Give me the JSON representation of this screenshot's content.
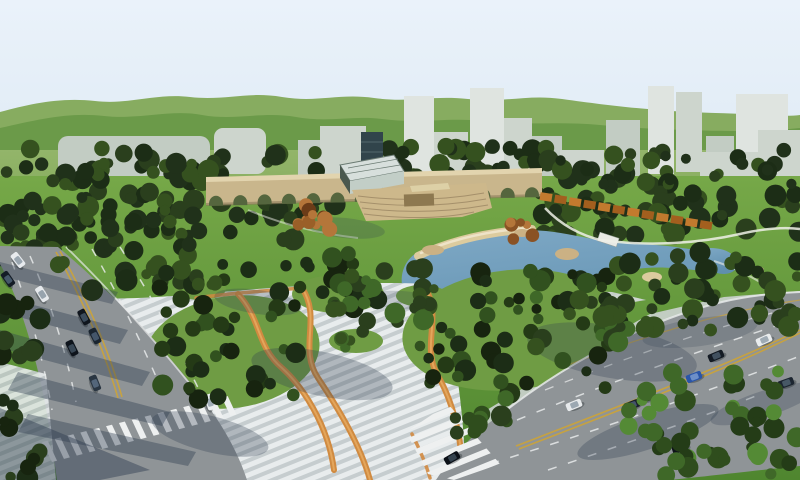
{
  "meta": {
    "description": "Aerial 3D architectural rendering of an urban park master plan: central lawn with arched bridge structure, glass pavilion and amphitheater, blue lake with sand beach and rocks, striped pedestrian plaza with winding orange paths, dense tree masses, two multi-lane boulevards with traffic and zebra crosswalks, pale city towers and green hills on the horizon",
    "render_width": 800,
    "render_height": 480
  },
  "palette": {
    "sky": "#eaf2fa",
    "sky_low": "#dde9f4",
    "hill_back": "#87ac60",
    "hill_front": "#6b9a49",
    "field_hi": "#93b56a",
    "field_lo": "#7ca653",
    "lawn_hi": "#76a848",
    "lawn_lo": "#4f862f",
    "building_light": "#dfe4e0",
    "building_mid": "#cdd5cd",
    "building_shade": "#c2ccc3",
    "tower_dark": "#31444b",
    "tower_stripe": "#54676e",
    "forest_dark": "#1c2d16",
    "forest_mid": "#2a3f1d",
    "autumn": "#8a5224",
    "autumn_light": "#b4763a",
    "structure_tan": "#c9b68c",
    "structure_cornice": "#e2d4ae",
    "structure_base": "#8a7a58",
    "arch_opening": "#55663e",
    "step_tan": "#cdb88b",
    "step_line": "#a5906b",
    "stage_brown": "#8d7850",
    "roof_cream": "#ddd0a6",
    "glass": "#d7dfdc",
    "glass_frame": "#6a7a72",
    "glass_side": "#4a584e",
    "glass_base": "#c2cec7",
    "wall_orange": "#c27a2e",
    "wall_orange_dark": "#a35f1e",
    "pond_hi": "#7fa9c6",
    "pond_lo": "#5f8fae",
    "pond_rim": "#c9d8e2",
    "sand": "#dccb9e",
    "sand_light": "#eee3c8",
    "rock": "#cbb184",
    "island_green": "#5d8f3a",
    "path_white": "#eef0e8",
    "plaza_stripe": "#e8eced",
    "plaza_stripe_dark": "#c6cdcf",
    "ribbon_orange": "#d08a40",
    "ribbon_light": "#e3a65c",
    "road": "#8f9497",
    "lane_white": "#e8eaea",
    "lane_yellow": "#c9a23c",
    "zebra_white": "#eef0f0",
    "curb": "#e4e8e9",
    "pavement_right": "#ccd3d0",
    "mound_green": "#6f9c44",
    "shadow": "#2e3c50",
    "car_shadow": "#10161c",
    "bridge_white": "#e9eae5"
  },
  "skyline": {
    "blocks": [
      {
        "x": 58,
        "y": 136,
        "w": 152,
        "h": 42,
        "rx": 10,
        "c": "building_shade"
      },
      {
        "x": 214,
        "y": 128,
        "w": 52,
        "h": 46,
        "rx": 9,
        "c": "building_mid"
      },
      {
        "x": 298,
        "y": 140,
        "w": 26,
        "h": 44,
        "rx": 0,
        "c": "building_shade"
      },
      {
        "x": 320,
        "y": 126,
        "w": 46,
        "h": 58,
        "rx": 0,
        "c": "building_mid"
      },
      {
        "x": 404,
        "y": 96,
        "w": 30,
        "h": 82,
        "rx": 0,
        "c": "building_light"
      },
      {
        "x": 434,
        "y": 132,
        "w": 34,
        "h": 46,
        "rx": 0,
        "c": "building_mid"
      },
      {
        "x": 470,
        "y": 88,
        "w": 34,
        "h": 90,
        "rx": 0,
        "c": "building_light"
      },
      {
        "x": 504,
        "y": 118,
        "w": 28,
        "h": 58,
        "rx": 0,
        "c": "building_mid"
      },
      {
        "x": 532,
        "y": 136,
        "w": 30,
        "h": 42,
        "rx": 0,
        "c": "building_shade"
      },
      {
        "x": 560,
        "y": 150,
        "w": 44,
        "h": 28,
        "rx": 0,
        "c": "building_mid"
      },
      {
        "x": 606,
        "y": 120,
        "w": 34,
        "h": 56,
        "rx": 0,
        "c": "building_shade"
      },
      {
        "x": 648,
        "y": 86,
        "w": 26,
        "h": 88,
        "rx": 0,
        "c": "building_light"
      },
      {
        "x": 676,
        "y": 92,
        "w": 26,
        "h": 80,
        "rx": 0,
        "c": "building_mid"
      },
      {
        "x": 706,
        "y": 136,
        "w": 28,
        "h": 40,
        "rx": 0,
        "c": "building_shade"
      },
      {
        "x": 736,
        "y": 94,
        "w": 52,
        "h": 78,
        "rx": 0,
        "c": "building_light"
      },
      {
        "x": 758,
        "y": 130,
        "w": 42,
        "h": 46,
        "rx": 0,
        "c": "building_mid"
      },
      {
        "x": 700,
        "y": 152,
        "w": 100,
        "h": 28,
        "rx": 0,
        "c": "building_mid"
      }
    ]
  },
  "forest": {
    "patches": [
      {
        "layer": "upper",
        "name": "forest-band-left",
        "x": 0,
        "y": 148,
        "w": 335,
        "h": 92,
        "n": 115,
        "seed": 7
      },
      {
        "layer": "upper",
        "name": "forest-band-center",
        "x": 375,
        "y": 146,
        "w": 175,
        "h": 44,
        "n": 50,
        "seed": 11
      },
      {
        "layer": "upper",
        "name": "forest-band-right",
        "x": 535,
        "y": 148,
        "w": 265,
        "h": 88,
        "n": 95,
        "seed": 13
      },
      {
        "layer": "upper",
        "name": "trees-topleft-roadside",
        "x": 0,
        "y": 205,
        "w": 70,
        "h": 55,
        "n": 16,
        "seed": 17
      },
      {
        "layer": "lower",
        "name": "trees-roadside-east",
        "x": 58,
        "y": 212,
        "w": 140,
        "h": 80,
        "n": 34,
        "seed": 19
      },
      {
        "layer": "lower",
        "name": "plaza-tree-cluster-west",
        "x": 158,
        "y": 262,
        "w": 150,
        "h": 138,
        "n": 42,
        "seed": 23,
        "colors": [
          "#17240f",
          "forest_dark",
          "#243a16",
          "#31511f"
        ]
      },
      {
        "layer": "lower",
        "name": "plaza-tree-cluster-north",
        "x": 296,
        "y": 252,
        "w": 84,
        "h": 58,
        "n": 18,
        "seed": 29,
        "colors": [
          "#17240f",
          "forest_dark",
          "#243a16",
          "#31511f"
        ]
      },
      {
        "layer": "lower",
        "name": "plaza-tree-cluster-central",
        "x": 418,
        "y": 266,
        "w": 205,
        "h": 128,
        "n": 55,
        "seed": 31,
        "colors": [
          "#17240f",
          "forest_dark",
          "#243a16",
          "#31511f"
        ]
      },
      {
        "layer": "lower",
        "name": "pond-west-trees",
        "x": 366,
        "y": 266,
        "w": 62,
        "h": 58,
        "n": 14,
        "seed": 37,
        "colors": [
          "forest_mid",
          "#35511f",
          "#3f6828"
        ]
      },
      {
        "layer": "lower",
        "name": "pond-east-trees",
        "x": 608,
        "y": 252,
        "w": 192,
        "h": 78,
        "n": 48,
        "seed": 41,
        "colors": [
          "forest_dark",
          "forest_mid",
          "#35511f"
        ]
      },
      {
        "layer": "lower",
        "name": "corner-trees-southeast",
        "x": 618,
        "y": 368,
        "w": 182,
        "h": 112,
        "n": 48,
        "seed": 43,
        "colors": [
          "#2f4d1d",
          "#3f6828",
          "#548a35",
          "#243c17"
        ]
      },
      {
        "layer": "lower",
        "name": "roadside-trees-west",
        "x": 0,
        "y": 298,
        "w": 44,
        "h": 182,
        "n": 24,
        "seed": 47,
        "colors": [
          "#17240f",
          "forest_dark",
          "forest_mid"
        ]
      },
      {
        "layer": "lower",
        "name": "verge-trees-north",
        "x": 532,
        "y": 296,
        "w": 96,
        "h": 52,
        "n": 18,
        "seed": 53,
        "colors": [
          "forest_mid",
          "#35511f",
          "#3f6828"
        ]
      },
      {
        "layer": "lower",
        "name": "autumn-trees-lawn",
        "x": 292,
        "y": 196,
        "w": 38,
        "h": 40,
        "n": 11,
        "seed": 59,
        "rmin": 4,
        "rmax": 9,
        "colors": [
          "autumn",
          "#9a5f28",
          "autumn_light",
          "#6b3c18"
        ]
      },
      {
        "layer": "lower",
        "name": "autumn-shrubs-pond",
        "x": 504,
        "y": 220,
        "w": 34,
        "h": 24,
        "n": 7,
        "seed": 61,
        "rmin": 3,
        "rmax": 7,
        "colors": [
          "autumn",
          "autumn_light",
          "#9a5f28"
        ]
      },
      {
        "layer": "lower",
        "name": "plaza-lone-trees-a",
        "x": 326,
        "y": 276,
        "w": 44,
        "h": 38,
        "n": 9,
        "seed": 67,
        "rmin": 4,
        "rmax": 9,
        "colors": [
          "forest_mid",
          "#35511f",
          "#3f6828"
        ]
      },
      {
        "layer": "lower",
        "name": "plaza-lone-trees-b",
        "x": 338,
        "y": 328,
        "w": 30,
        "h": 24,
        "n": 6,
        "seed": 71,
        "rmin": 4,
        "rmax": 8,
        "colors": [
          "forest_mid",
          "#35511f",
          "#3f6828"
        ]
      },
      {
        "layer": "lower",
        "name": "plaza-lone-trees-c",
        "x": 192,
        "y": 278,
        "w": 26,
        "h": 20,
        "n": 5,
        "seed": 73,
        "rmin": 4,
        "rmax": 8,
        "colors": [
          "forest_mid",
          "#35511f"
        ]
      },
      {
        "layer": "lower",
        "name": "plaza-lone-trees-d",
        "x": 414,
        "y": 286,
        "w": 26,
        "h": 20,
        "n": 5,
        "seed": 79,
        "rmin": 4,
        "rmax": 8,
        "colors": [
          "forest_mid",
          "#35511f"
        ]
      },
      {
        "layer": "lower",
        "name": "trees-crosswalk-north",
        "x": 455,
        "y": 398,
        "w": 60,
        "h": 36,
        "n": 11,
        "seed": 83,
        "colors": [
          "#2f4d1d",
          "#3f6828",
          "forest_mid"
        ]
      }
    ],
    "default_colors": [
      "forest_dark",
      "forest_mid",
      "#35511f",
      "#20311a"
    ]
  },
  "park": {
    "aqueduct": {
      "x1": 206,
      "x2": 542,
      "y_top": 171,
      "y_bottom": 205,
      "arches": 14
    },
    "pergola": {
      "x1": 546,
      "y1": 197,
      "x2": 706,
      "y2": 225,
      "segments": 12
    },
    "rocks": [
      {
        "x": 433,
        "y": 250,
        "rx": 11,
        "ry": 5,
        "c": "rock"
      },
      {
        "x": 567,
        "y": 254,
        "rx": 12,
        "ry": 6,
        "c": "rock"
      },
      {
        "x": 522,
        "y": 233,
        "rx": 8,
        "ry": 4,
        "c": "rock"
      },
      {
        "x": 652,
        "y": 277,
        "rx": 10,
        "ry": 5,
        "c": "sand"
      },
      {
        "x": 757,
        "y": 270,
        "rx": 7,
        "ry": 4,
        "c": "rock"
      }
    ],
    "islands": [
      {
        "x": 481,
        "y": 303,
        "rx": 15,
        "ry": 6
      },
      {
        "x": 448,
        "y": 300,
        "rx": 8,
        "ry": 4
      }
    ],
    "mounds": [
      [
        232,
        352,
        88,
        56,
        -8
      ],
      [
        512,
        330,
        110,
        60,
        -6
      ],
      [
        338,
        294,
        46,
        19,
        0
      ],
      [
        356,
        341,
        27,
        12,
        0
      ],
      [
        200,
        289,
        26,
        11,
        0
      ],
      [
        422,
        296,
        26,
        11,
        0
      ]
    ]
  },
  "traffic": {
    "car_size": {
      "w": 16,
      "h": 8
    },
    "cars": [
      {
        "x": 18,
        "y": 260,
        "a": 52,
        "c": "#e8ebee",
        "r": "#9aa6b0"
      },
      {
        "x": 8,
        "y": 279,
        "a": 55,
        "c": "#141c26",
        "r": "#46586a"
      },
      {
        "x": 42,
        "y": 294,
        "a": 58,
        "c": "#e6e9ec",
        "r": "#97a3ad"
      },
      {
        "x": 84,
        "y": 317,
        "a": 62,
        "c": "#10161e",
        "r": "#3c4c5c"
      },
      {
        "x": 95,
        "y": 336,
        "a": 64,
        "c": "#1a2530",
        "r": "#44566a"
      },
      {
        "x": 72,
        "y": 348,
        "a": 64,
        "c": "#0e141c",
        "r": "#394856"
      },
      {
        "x": 95,
        "y": 383,
        "a": 68,
        "c": "#2a3642",
        "r": "#54667a"
      },
      {
        "x": 210,
        "y": 402,
        "a": 72,
        "c": "#eceff1",
        "r": "#a2aeb8"
      },
      {
        "x": 648,
        "y": 397,
        "a": -20,
        "c": "#10161f",
        "r": "#3e4e60"
      },
      {
        "x": 694,
        "y": 377,
        "a": -21,
        "c": "#2a55a8",
        "r": "#6d8fc8"
      },
      {
        "x": 716,
        "y": 356,
        "a": -23,
        "c": "#141b24",
        "r": "#41505f"
      },
      {
        "x": 764,
        "y": 340,
        "a": -24,
        "c": "#e9eced",
        "r": "#9fabb4"
      },
      {
        "x": 786,
        "y": 383,
        "a": -20,
        "c": "#1c2530",
        "r": "#475866"
      },
      {
        "x": 680,
        "y": 448,
        "a": -18,
        "c": "#0d1219",
        "r": "#38475a"
      },
      {
        "x": 452,
        "y": 458,
        "a": -30,
        "c": "#0c1118",
        "r": "#34424e"
      },
      {
        "x": 574,
        "y": 405,
        "a": -22,
        "c": "#e7eaec",
        "r": "#9ca8b2"
      },
      {
        "x": 632,
        "y": 405,
        "a": -21,
        "c": "#191f2a",
        "r": "#44536a"
      }
    ]
  },
  "shadows": {
    "bands": [
      [
        0,
        262,
        118,
        292,
        112,
        304,
        0,
        276,
        0.36
      ],
      [
        0,
        296,
        128,
        330,
        120,
        344,
        0,
        312,
        0.38
      ],
      [
        0,
        330,
        150,
        372,
        142,
        386,
        0,
        348,
        0.38
      ],
      [
        18,
        372,
        170,
        412,
        162,
        426,
        8,
        390,
        0.4
      ],
      [
        28,
        414,
        196,
        452,
        188,
        466,
        18,
        432,
        0.4
      ],
      [
        0,
        408,
        150,
        470,
        100,
        480,
        0,
        480,
        0.45
      ]
    ],
    "ellipses": [
      [
        322,
        374,
        72,
        22,
        12,
        0.3
      ],
      [
        612,
        352,
        86,
        26,
        10,
        0.28
      ],
      [
        258,
        302,
        44,
        12,
        8,
        0.26
      ],
      [
        648,
        432,
        74,
        17,
        -18,
        0.3
      ],
      [
        764,
        404,
        56,
        13,
        -18,
        0.26
      ],
      [
        700,
        332,
        58,
        14,
        -8,
        0.2
      ],
      [
        345,
        228,
        40,
        10,
        6,
        0.22
      ],
      [
        402,
        300,
        34,
        9,
        4,
        0.2
      ],
      [
        210,
        434,
        60,
        18,
        14,
        0.3
      ]
    ]
  }
}
